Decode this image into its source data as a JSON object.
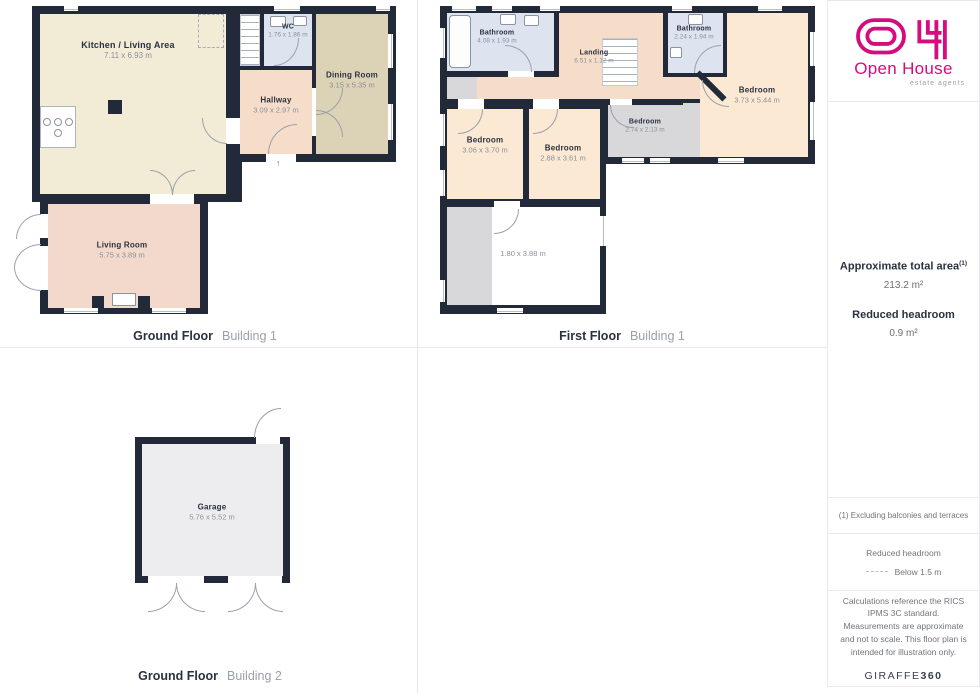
{
  "brand": {
    "name": "Open House",
    "tagline": "estate agents",
    "brand_color": "#D60C7D",
    "credit_regular": "GIRAFFE",
    "credit_bold": "360"
  },
  "icons": {
    "entrance_arrow": "↑"
  },
  "summary": {
    "total_area_label": "Approximate total area",
    "total_area_note_ref": "(1)",
    "total_area_value": "213.2 m²",
    "reduced_headroom_label": "Reduced headroom",
    "reduced_headroom_value": "0.9 m²"
  },
  "notes": {
    "footnote": "(1) Excluding balconies and terraces",
    "legend_title": "Reduced headroom",
    "legend_label": "Below 1.5 m",
    "disclaimer": "Calculations reference the RICS IPMS 3C standard. Measurements are approximate and not to scale. This floor plan is intended for illustration only."
  },
  "colors": {
    "wall": "#222939",
    "kitchen": "#F2ECD7",
    "dining": "#DCD2B5",
    "hallway": "#F5DDC9",
    "living": "#F2D9CC",
    "bedroom": "#FBE9D3",
    "bathroom": "#DDE4F0",
    "reduced": "#D8D8DA",
    "garage": "#EDEDEF"
  },
  "floors": {
    "ground1": {
      "caption": "Ground Floor",
      "building": "Building 1",
      "rooms": {
        "kitchen": {
          "name": "Kitchen / Living Area",
          "dims": "7.11 x 6.93 m"
        },
        "wc": {
          "name": "WC",
          "dims": "1.76 x 1.86 m"
        },
        "hallway": {
          "name": "Hallway",
          "dims": "3.09 x 2.97 m"
        },
        "dining": {
          "name": "Dining Room",
          "dims": "3.15 x 5.35 m"
        },
        "living": {
          "name": "Living Room",
          "dims": "5.75 x 3.89 m"
        }
      }
    },
    "first1": {
      "caption": "First Floor",
      "building": "Building 1",
      "rooms": {
        "bathroom1": {
          "name": "Bathroom",
          "dims": "4.08 x 1.93 m"
        },
        "landing": {
          "name": "Landing",
          "dims": "6.51 x 1.12 m"
        },
        "bathroom2": {
          "name": "Bathroom",
          "dims": "2.24 x 1.94 m"
        },
        "bedroom_right": {
          "name": "Bedroom",
          "dims": "3.73 x 5.44 m"
        },
        "bedroom_small": {
          "name": "Bedroom",
          "dims": "2.74 x 2.13 m"
        },
        "bedroom_left": {
          "name": "Bedroom",
          "dims": "3.06 x 3.70 m"
        },
        "bedroom_mid": {
          "name": "Bedroom",
          "dims": "2.88 x 3.61 m"
        },
        "storage": {
          "dims": "1.80 x 3.88 m"
        }
      }
    },
    "ground2": {
      "caption": "Ground Floor",
      "building": "Building 2",
      "rooms": {
        "garage": {
          "name": "Garage",
          "dims": "5.76 x 5.52 m"
        }
      }
    }
  }
}
